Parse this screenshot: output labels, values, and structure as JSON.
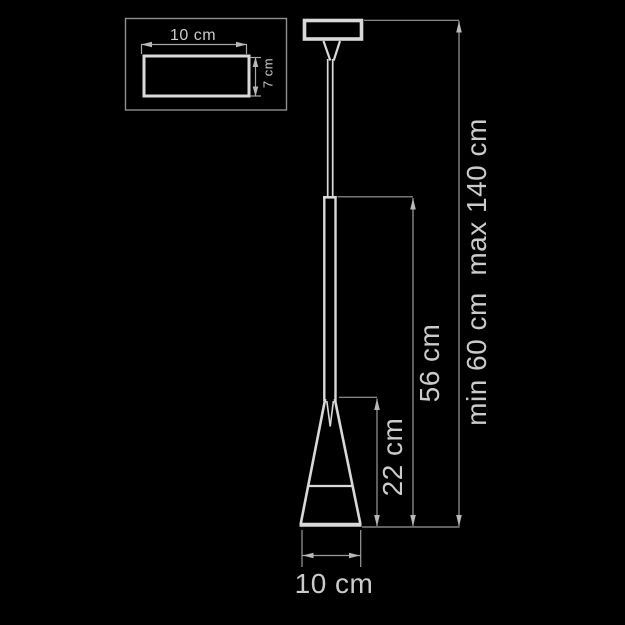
{
  "diagram": {
    "type": "pendant-lamp-dimension-drawing",
    "detail_view": {
      "description": "canopy top view",
      "width_label": "10 cm",
      "height_label": "7 cm"
    },
    "main_view": {
      "shade_height_label": "22 cm",
      "body_height_label": "56 cm",
      "suspension_label": "min 60 cm  max 140 cm",
      "shade_diameter_label": "10 cm"
    },
    "colors": {
      "background": "#000000",
      "outline": "#d9d9d9",
      "dimension_line": "#9b9b9b",
      "arrow": "#b8b8b8",
      "text": "#cbcbcb"
    }
  }
}
